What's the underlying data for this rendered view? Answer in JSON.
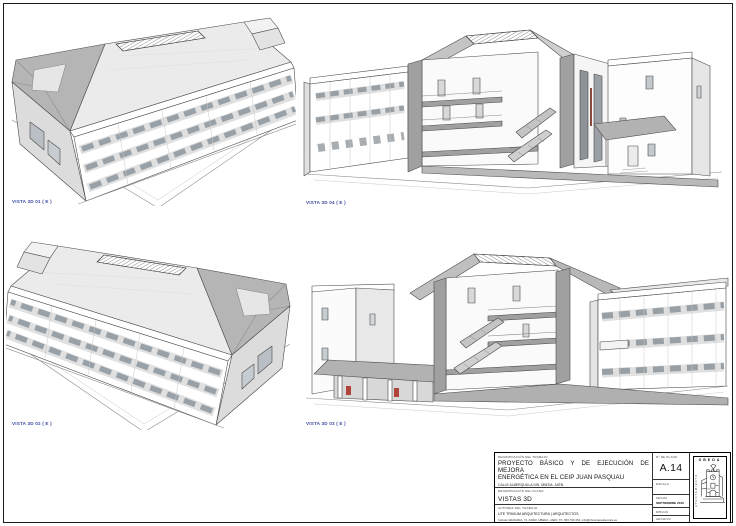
{
  "document": {
    "kind": "architectural-drawing-sheet",
    "sheet_size": "736x526"
  },
  "palette": {
    "accent_blue": "#3b4ba1",
    "roof_light": "#ebebeb",
    "roof_dark": "#b5b5b5",
    "poche_gray": "#a0a0a0",
    "line": "#4a4a4a",
    "paper": "#ffffff"
  },
  "views": [
    {
      "id": "vista-3d-01",
      "label": "VISTA 3D 01 ( E )",
      "type": "aerial-axonometric"
    },
    {
      "id": "vista-3d-04",
      "label": "VISTA 3D 04 ( E )",
      "type": "section-perspective"
    },
    {
      "id": "vista-3d-02",
      "label": "VISTA 3D 02 ( E )",
      "type": "aerial-axonometric"
    },
    {
      "id": "vista-3d-03",
      "label": "VISTA 3D 03 ( E )",
      "type": "section-perspective"
    }
  ],
  "title_block": {
    "work_label": "DENOMINACIÓN DEL TRABAJO",
    "work_title_line1": "PROYECTO BÁSICO Y DE EJECUCIÓN DE MEJORA",
    "work_title_line2": "ENERGÉTICA EN EL CEIP JUAN PASQUAU",
    "work_address": "CALLE ALBERQUILLA S/N. ÚBEDA. JAÉN.",
    "plan_label": "DENOMINACIÓN DEL PLANO",
    "plan_title": "VISTAS 3D",
    "authors_label": "AUTORES DEL TRABAJO",
    "authors_line1": "UTE TRIVIUM ARQUITECTURA | ARQUITECTOS",
    "authors_line2": "CALLE GRANADA, 74. 23400. ÚBEDA. JAÉN. TF: 953 790 452. info@triviumarquitectura.es",
    "number_label": "Nº DE PLANO",
    "number": "A.14",
    "scale_label": "ESCALA",
    "scale_value": "",
    "date_label": "FECHA",
    "date_value": "SEPTIEMBRE 2016",
    "drawn_label": "DIBUJO",
    "file_label": "ARCHIVO",
    "logo_city": "ÚBEDA",
    "logo_vertical_text": "AYUNTAMIENTO"
  }
}
